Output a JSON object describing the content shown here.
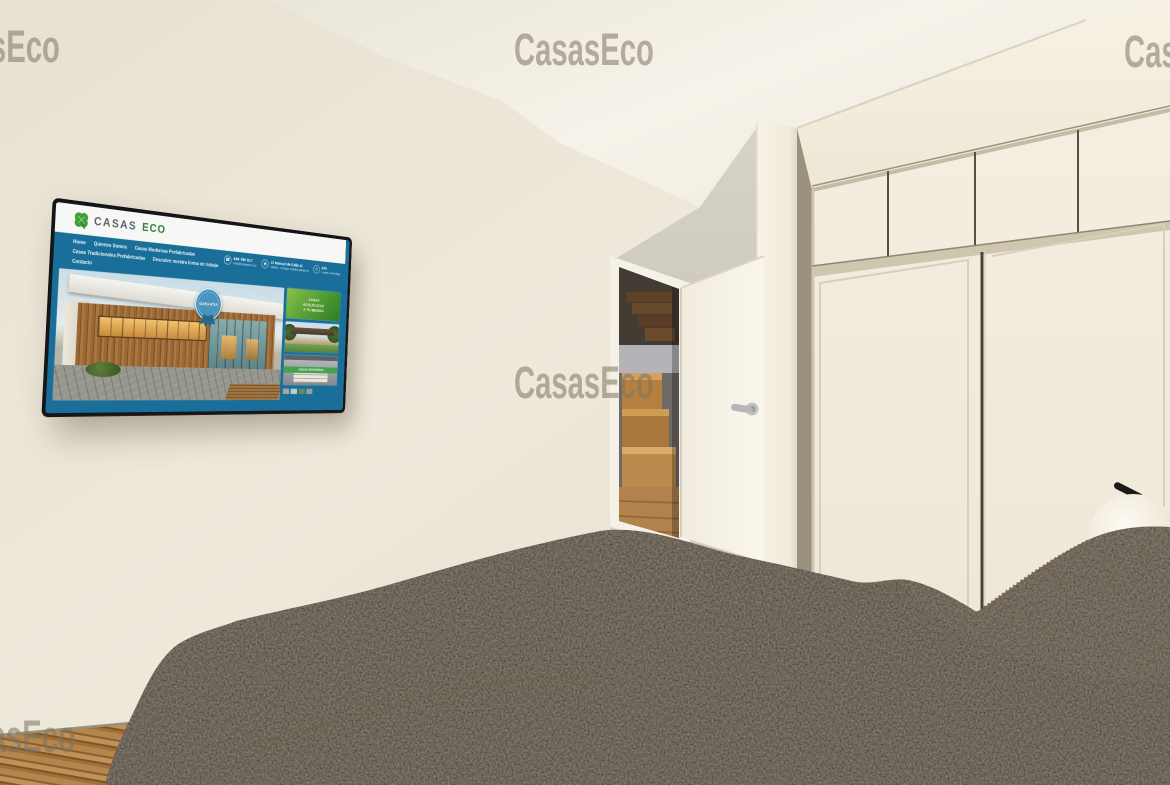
{
  "watermark": {
    "text": "CasasEco"
  },
  "scene": {
    "description": "3D interior render of a bedroom: wall-mounted TV showing the CasasEco website, open white door revealing a wooden staircase, white sliding-door wardrobe, dark textured bedspread and pillows, white sphere wall lamp, wooden floor",
    "colors": {
      "wall": "#EAE4D6",
      "ceiling": "#F4F0E7",
      "wardrobe": "#F1EBDD",
      "bed": "#35312B",
      "floor_wood": "#A97B45",
      "watermark": "#80755F",
      "website_blue": "#1A6F9A",
      "website_green": "#3FA03A"
    }
  },
  "tv": {
    "website": {
      "brand": {
        "logo_icon": "clover-icon",
        "name_primary": "CASAS",
        "name_secondary": "ECO"
      },
      "nav": [
        "Home",
        "Quienes Somos",
        "Casas Modernas Prefabricadas",
        "Casas Tradicionales Prefabricadas",
        "Descubre nuestra forma de trabajo",
        "Contacto"
      ],
      "contact": {
        "phone": "649 780 617",
        "email": "info@casaseco.es",
        "address_line1": "C/ Manuel de Falla 11",
        "address_line2": "28400 - Collado Villalba (Madrid)",
        "hours": "24h",
        "hours_sub": "Lunes a Domingo"
      },
      "hero_badge": "GARANTÍA",
      "sidebar": {
        "tile1_lines": [
          "CASAS",
          "ECOLÓGICAS",
          "A TU MEDIDA"
        ],
        "tile3_ribbon": "CASAS MODERNAS"
      }
    }
  }
}
